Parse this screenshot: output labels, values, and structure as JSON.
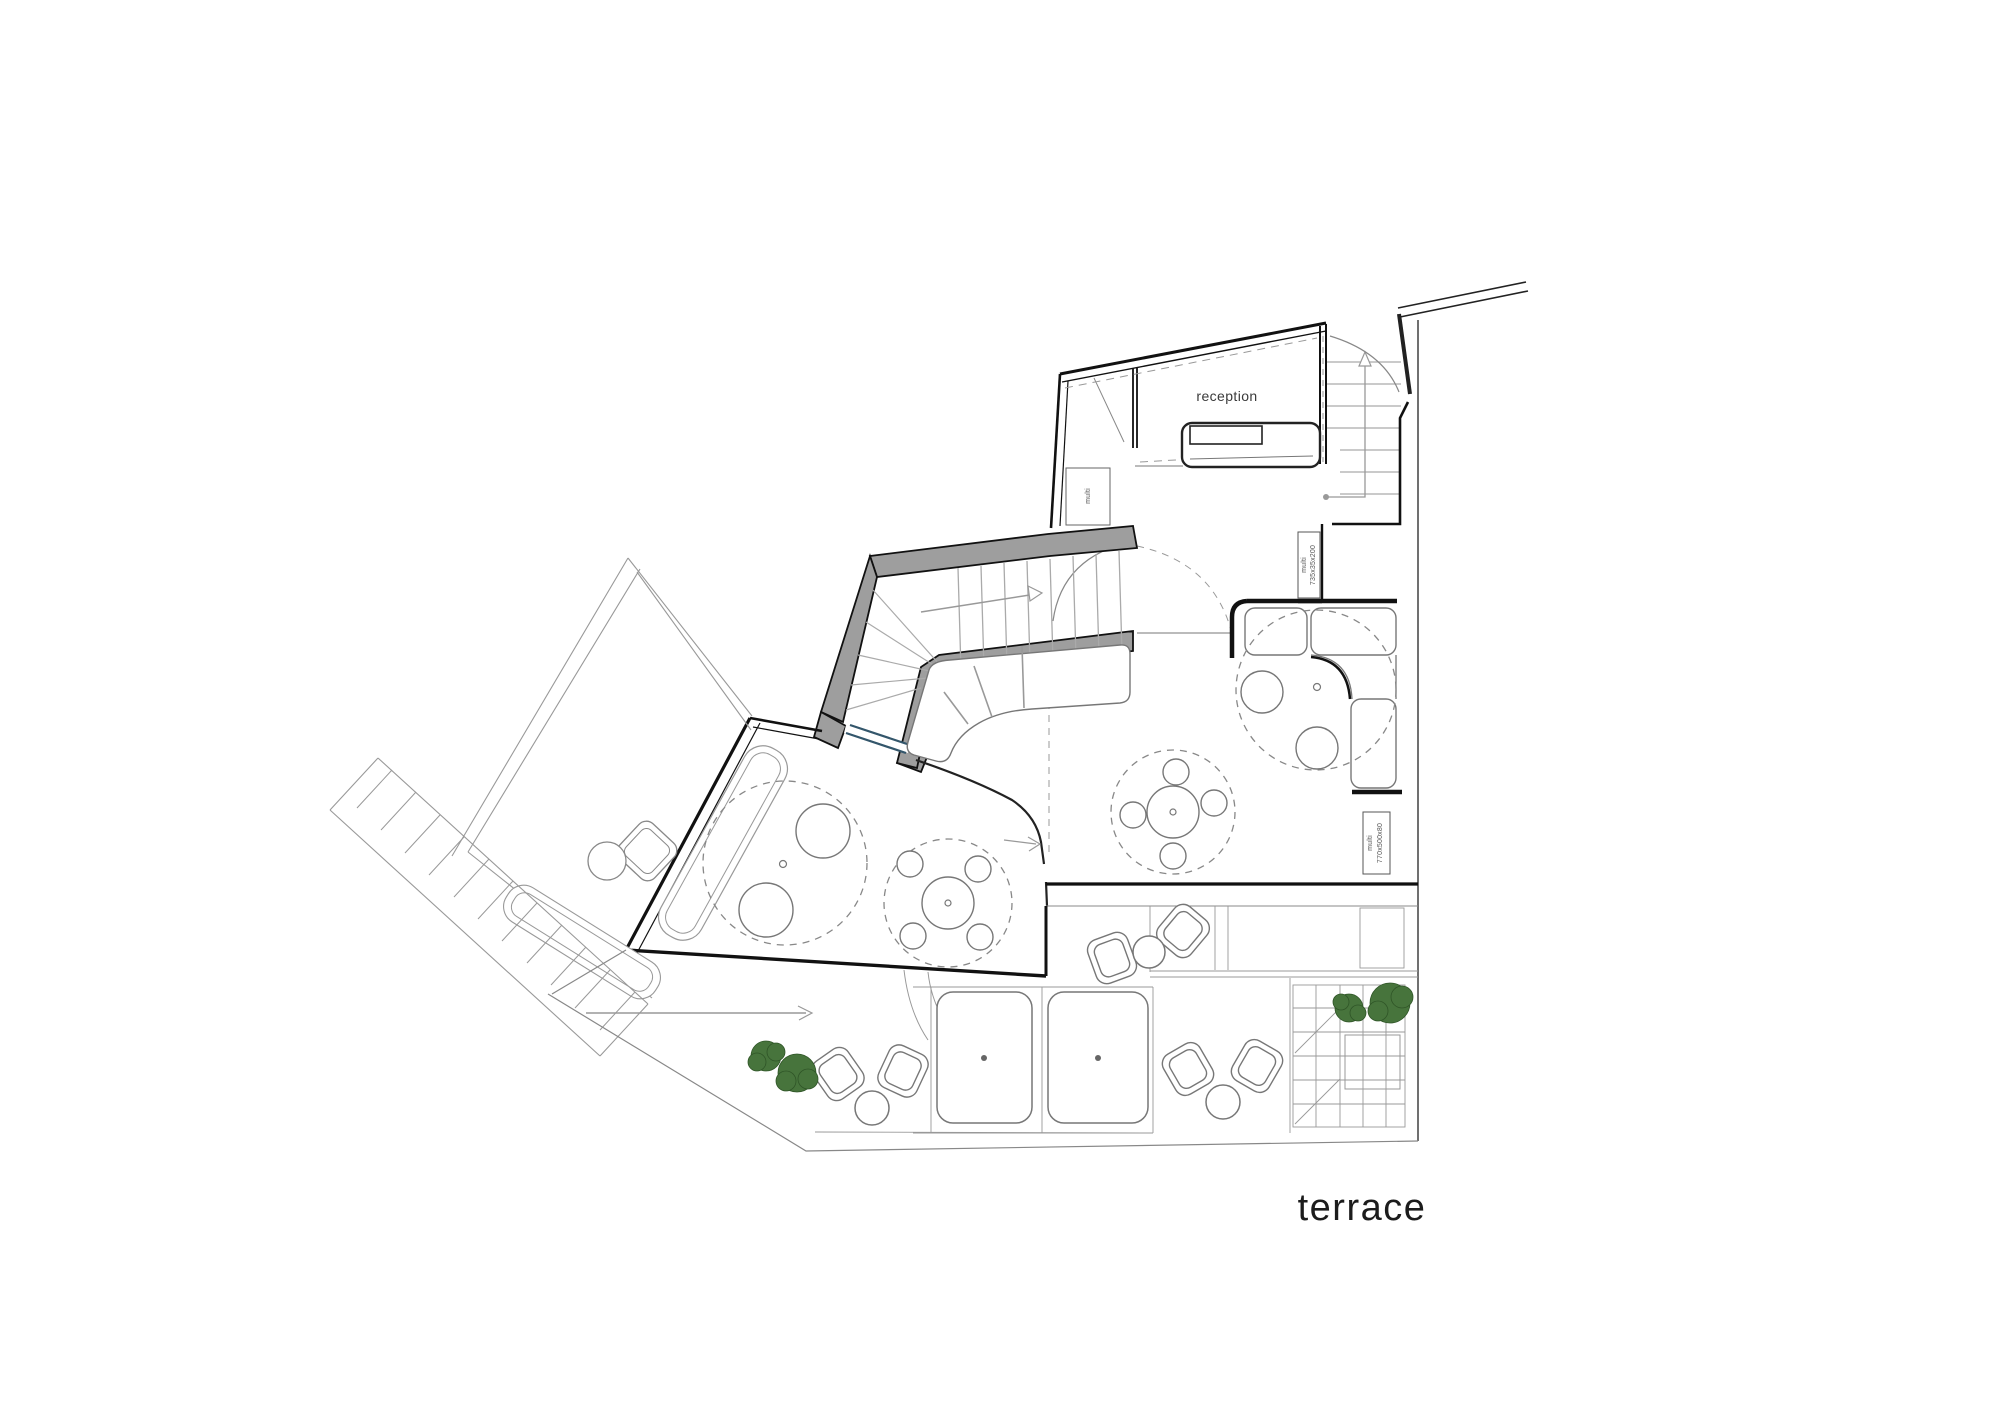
{
  "plan": {
    "rooms": {
      "reception_label": "reception",
      "terrace_label": "terrace"
    },
    "annotations": {
      "cabinet_small_label": "multi",
      "cabinet_tall": {
        "line1": "multi",
        "line2": "735x35x200"
      },
      "cabinet_low": {
        "line1": "multi",
        "line2": "770x500x80"
      }
    },
    "colors": {
      "background": "#ffffff",
      "wall": "#1a1a1a",
      "wall_highlight_fill": "#9e9e9e",
      "light_line": "#8a8a8a",
      "furniture_line": "#777777",
      "glazing": "#33566b",
      "tree_fill": "#47743c",
      "tree_stroke": "#2f5527"
    }
  }
}
